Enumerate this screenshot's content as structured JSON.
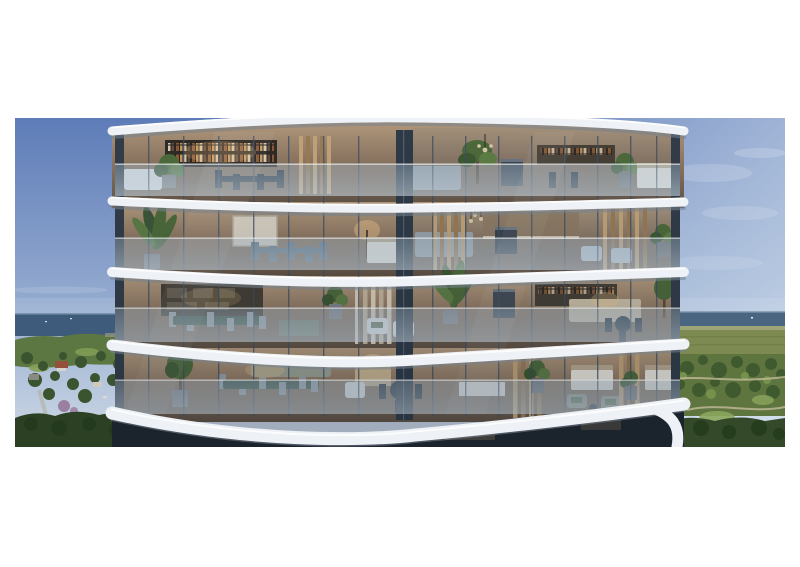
{
  "meta": {
    "alt": "Photorealistic architectural rendering: close-up of a curved glass apartment tower with four visible floors of warmly lit furnished interiors behind ribbon balconies with white sculptural slab edges, flanked by dusk sky, with a sea horizon and green coastal parkland visible below on both sides, inset on a white page",
    "type": "architectural-rendering-photograph",
    "image_area": {
      "left": 15,
      "top": 118,
      "width": 770,
      "height": 329
    }
  },
  "scene": {
    "regions": {
      "sky": "blue dusk gradient, deeper at upper left, paler with wispy clouds at right",
      "ocean_left": "dark blue sea strip with horizon at upper left",
      "ocean_right": "blue-grey sea strip with horizon at upper right",
      "parkland_left": "coastal headland suburb: lawns, dense trees, red-roofed house, purple flowering tree, small roads",
      "parkland_right": "olive-green parkland with winding light paths, tree clusters and dark woods at bottom",
      "building": "two-lobed curved glass facade, four floors, white curved balcony slabs, glass balustrades, dark mullions"
    },
    "floors": [
      {
        "label": "floor-1",
        "items": "bookshelf wall, dark dining chairs, white sofa, potted plants, grey sofa, tree in planter, barbecue unit, rear shelving, bed, pendant light"
      },
      {
        "label": "floor-2",
        "items": "banana palm, framed wall art, blue-grey dining chairs, glowing floor lamp, bed, grey sofa, gold curtains, barbecue, pendant cluster, pale armchairs"
      },
      {
        "label": "floor-3",
        "items": "timber shelving, green marble dining table with grey chairs, glass console, white armchairs with green cushions, terrace palm, barbecue, rear bookshelf, beige sofa, dark bistro set, olive tree"
      },
      {
        "label": "floor-4",
        "items": "olive tree in pot, green marble dining table, sage sofa, arched mirror, white armchair, dark bistro set, kitchen island, gold curtains, two beds, armchairs with green cushions"
      }
    ]
  },
  "palette": {
    "page_bg": "#ffffff",
    "sky_top": "#5e7cb8",
    "sky_mid": "#93aacf",
    "sky_low": "#cfdae6",
    "sky_right_haze": "#dfeaf3",
    "cloud": "#ffffff",
    "ocean_left": "#3e5b7b",
    "ocean_right": "#49657f",
    "horizon_line": "#8ba2b8",
    "headland_green": "#5d7743",
    "trees_dark": "#3a5430",
    "park_tree": "#3f5a2f",
    "lawn_green": "#86a057",
    "olive_field": "#7d8b53",
    "dune": "#9aa06b",
    "park_green": "#5f7540",
    "glade_green": "#8ba65c",
    "path_tan": "#c3bc98",
    "forest_dark_left": "#2c4124",
    "forest_dark_right": "#33492a",
    "roof_red": "#94503a",
    "tree_purple": "#9b7fa3",
    "interior_top": "#b59c7e",
    "interior_mid": "#8a7460",
    "interior_low": "#5f5143",
    "facade_shade": "#0f1928",
    "slab_white": "#eef1f5",
    "slab_shadow": "#76828e",
    "soffit_brown": "#4a3f35",
    "glass_top": "#adc3d4",
    "glass_low": "#cfdde8",
    "mullion": "#3d4e60",
    "column": "#323d49",
    "center_column": "#2e3a46",
    "curtain_gold": "#c2a376",
    "curtain_gold_dark": "#9a7b55",
    "curtain_pale": "#d8cdb8",
    "plant_green": "#4c6a3a",
    "plant_dark": "#3c5830",
    "sofa_grey": "#99a3ab",
    "sofa_beige": "#c9bda6",
    "chair_dark": "#26323e",
    "chair_blue": "#5d7384",
    "chair_white": "#e2e4e6",
    "cushion_green": "#5c7050",
    "marble_green": "#41584a",
    "bed_white": "#e9e5dc",
    "lamp_glow": "#f0c689",
    "bbq_body": "#39434e",
    "mirror_brass": "#c9b490"
  }
}
